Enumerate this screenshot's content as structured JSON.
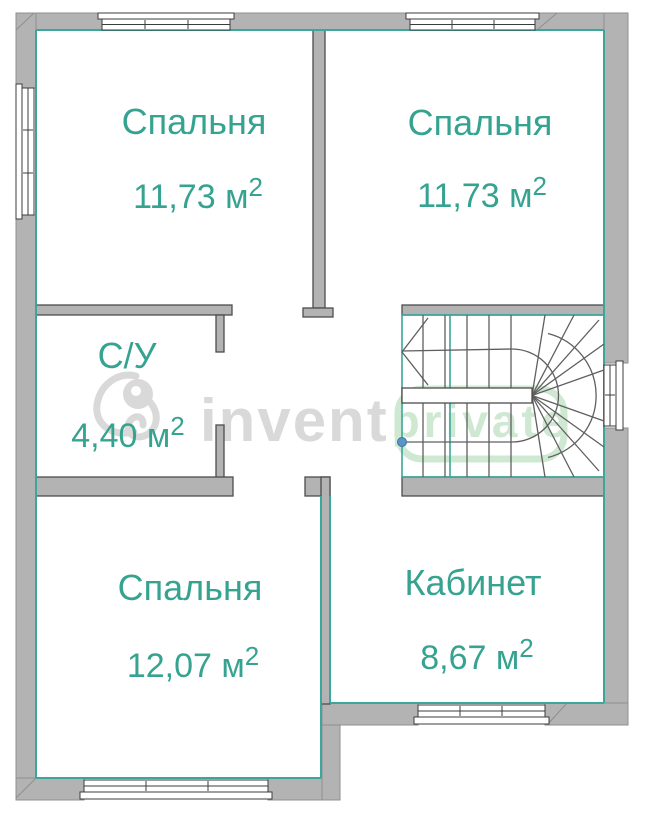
{
  "document_type": "floor-plan",
  "rooms": [
    {
      "name": "Спальня",
      "area": "11,73 м",
      "sup": "2"
    },
    {
      "name": "Спальня",
      "area": "11,73 м",
      "sup": "2"
    },
    {
      "name": "С/У",
      "area": "4,40 м",
      "sup": "2"
    },
    {
      "name": "Спальня",
      "area": "12,07 м",
      "sup": "2"
    },
    {
      "name": "Кабинет",
      "area": "8,67 м",
      "sup": "2"
    }
  ],
  "watermark": {
    "brand": "invent",
    "badge": "private"
  },
  "colors": {
    "wall": "#b3b3b3",
    "wall_edge": "#4d4d4d",
    "exterior_edge": "#8f8f8f",
    "room_line": "#3aa79a",
    "label": "#36a391",
    "stair_line": "#5f5f5f",
    "window_line": "#3c3c3c",
    "watermark_gray": "#d9d9d9",
    "watermark_green": "#cfe8d2",
    "dot_blue": "#5a95c6"
  }
}
